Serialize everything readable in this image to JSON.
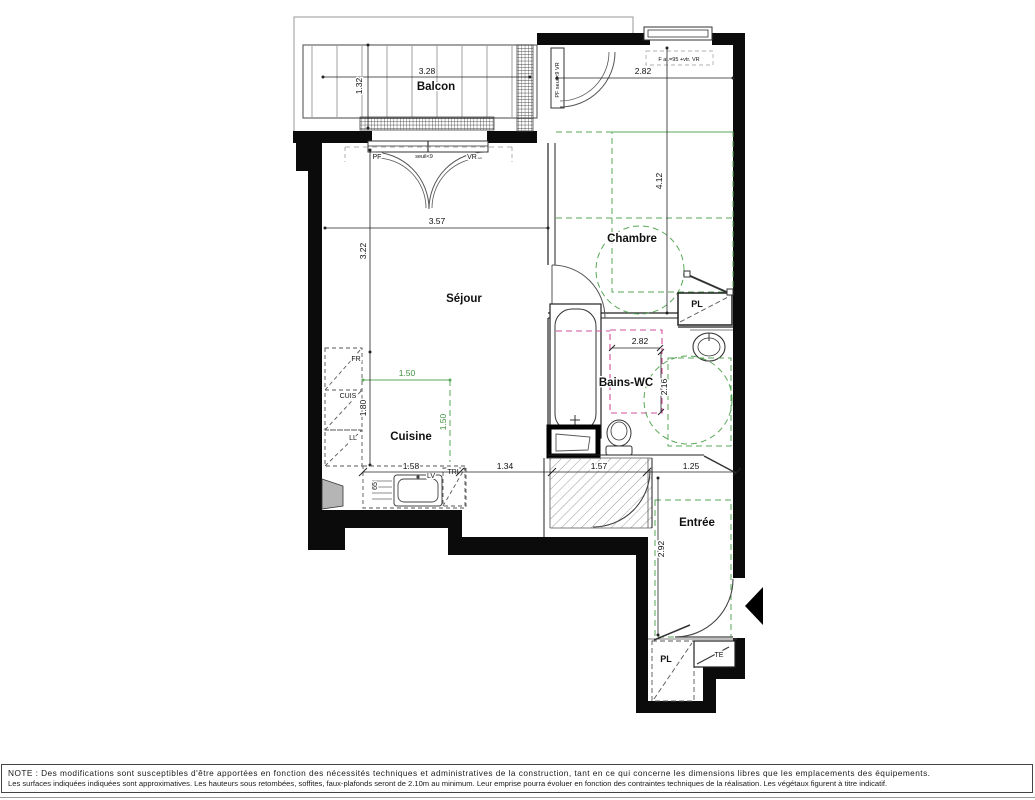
{
  "plan": {
    "rooms": {
      "balcon": "Balcon",
      "sejour": "Séjour",
      "cuisine": "Cuisine",
      "chambre": "Chambre",
      "bains_wc": "Bains-WC",
      "entree": "Entrée",
      "pl": "PL",
      "te": "TE"
    },
    "dims": {
      "d_328": "3.28",
      "d_132": "1.32",
      "d_357": "3.57",
      "d_322": "3.22",
      "d_282_chambre": "2.82",
      "d_412": "4.12",
      "d_150h": "1.50",
      "d_150v": "1.50",
      "d_180": "1.80",
      "d_65": "65",
      "d_158": "1.58",
      "d_134": "1.34",
      "d_157": "1.57",
      "d_125": "1.25",
      "d_282_bains": "2.82",
      "d_216": "2.16",
      "d_292": "2.92"
    },
    "ann": {
      "pf": "PF",
      "vr": "VR",
      "seuil": "seuil<9",
      "pf_seuil_vr": "PF  seuil<9  VR",
      "fenetre_chambre": "F al.=95 +vtr.  VR",
      "fr": "FR",
      "cuis": "CUIS",
      "ll": "LL",
      "lv": "LV",
      "tri": "TRI"
    },
    "colors": {
      "wall": "#0b0b0b",
      "accessibility_green": "#5aa85a",
      "bath_zone_pink": "#d0509b"
    }
  },
  "note": {
    "line1": "NOTE  :  Des modifications sont susceptibles d'être apportées en fonction des nécessités techniques et administratives de la construction, tant en ce qui concerne les dimensions libres que les emplacements des équipements.",
    "line2": "Les surfaces indiquées indiquées sont approximatives. Les hauteurs sous retombées, soffites, faux-plafonds seront de 2.10m au minimum. Leur emprise pourra évoluer en fonction des contraintes techniques de la réalisation. Les végétaux figurent à titre indicatif."
  }
}
